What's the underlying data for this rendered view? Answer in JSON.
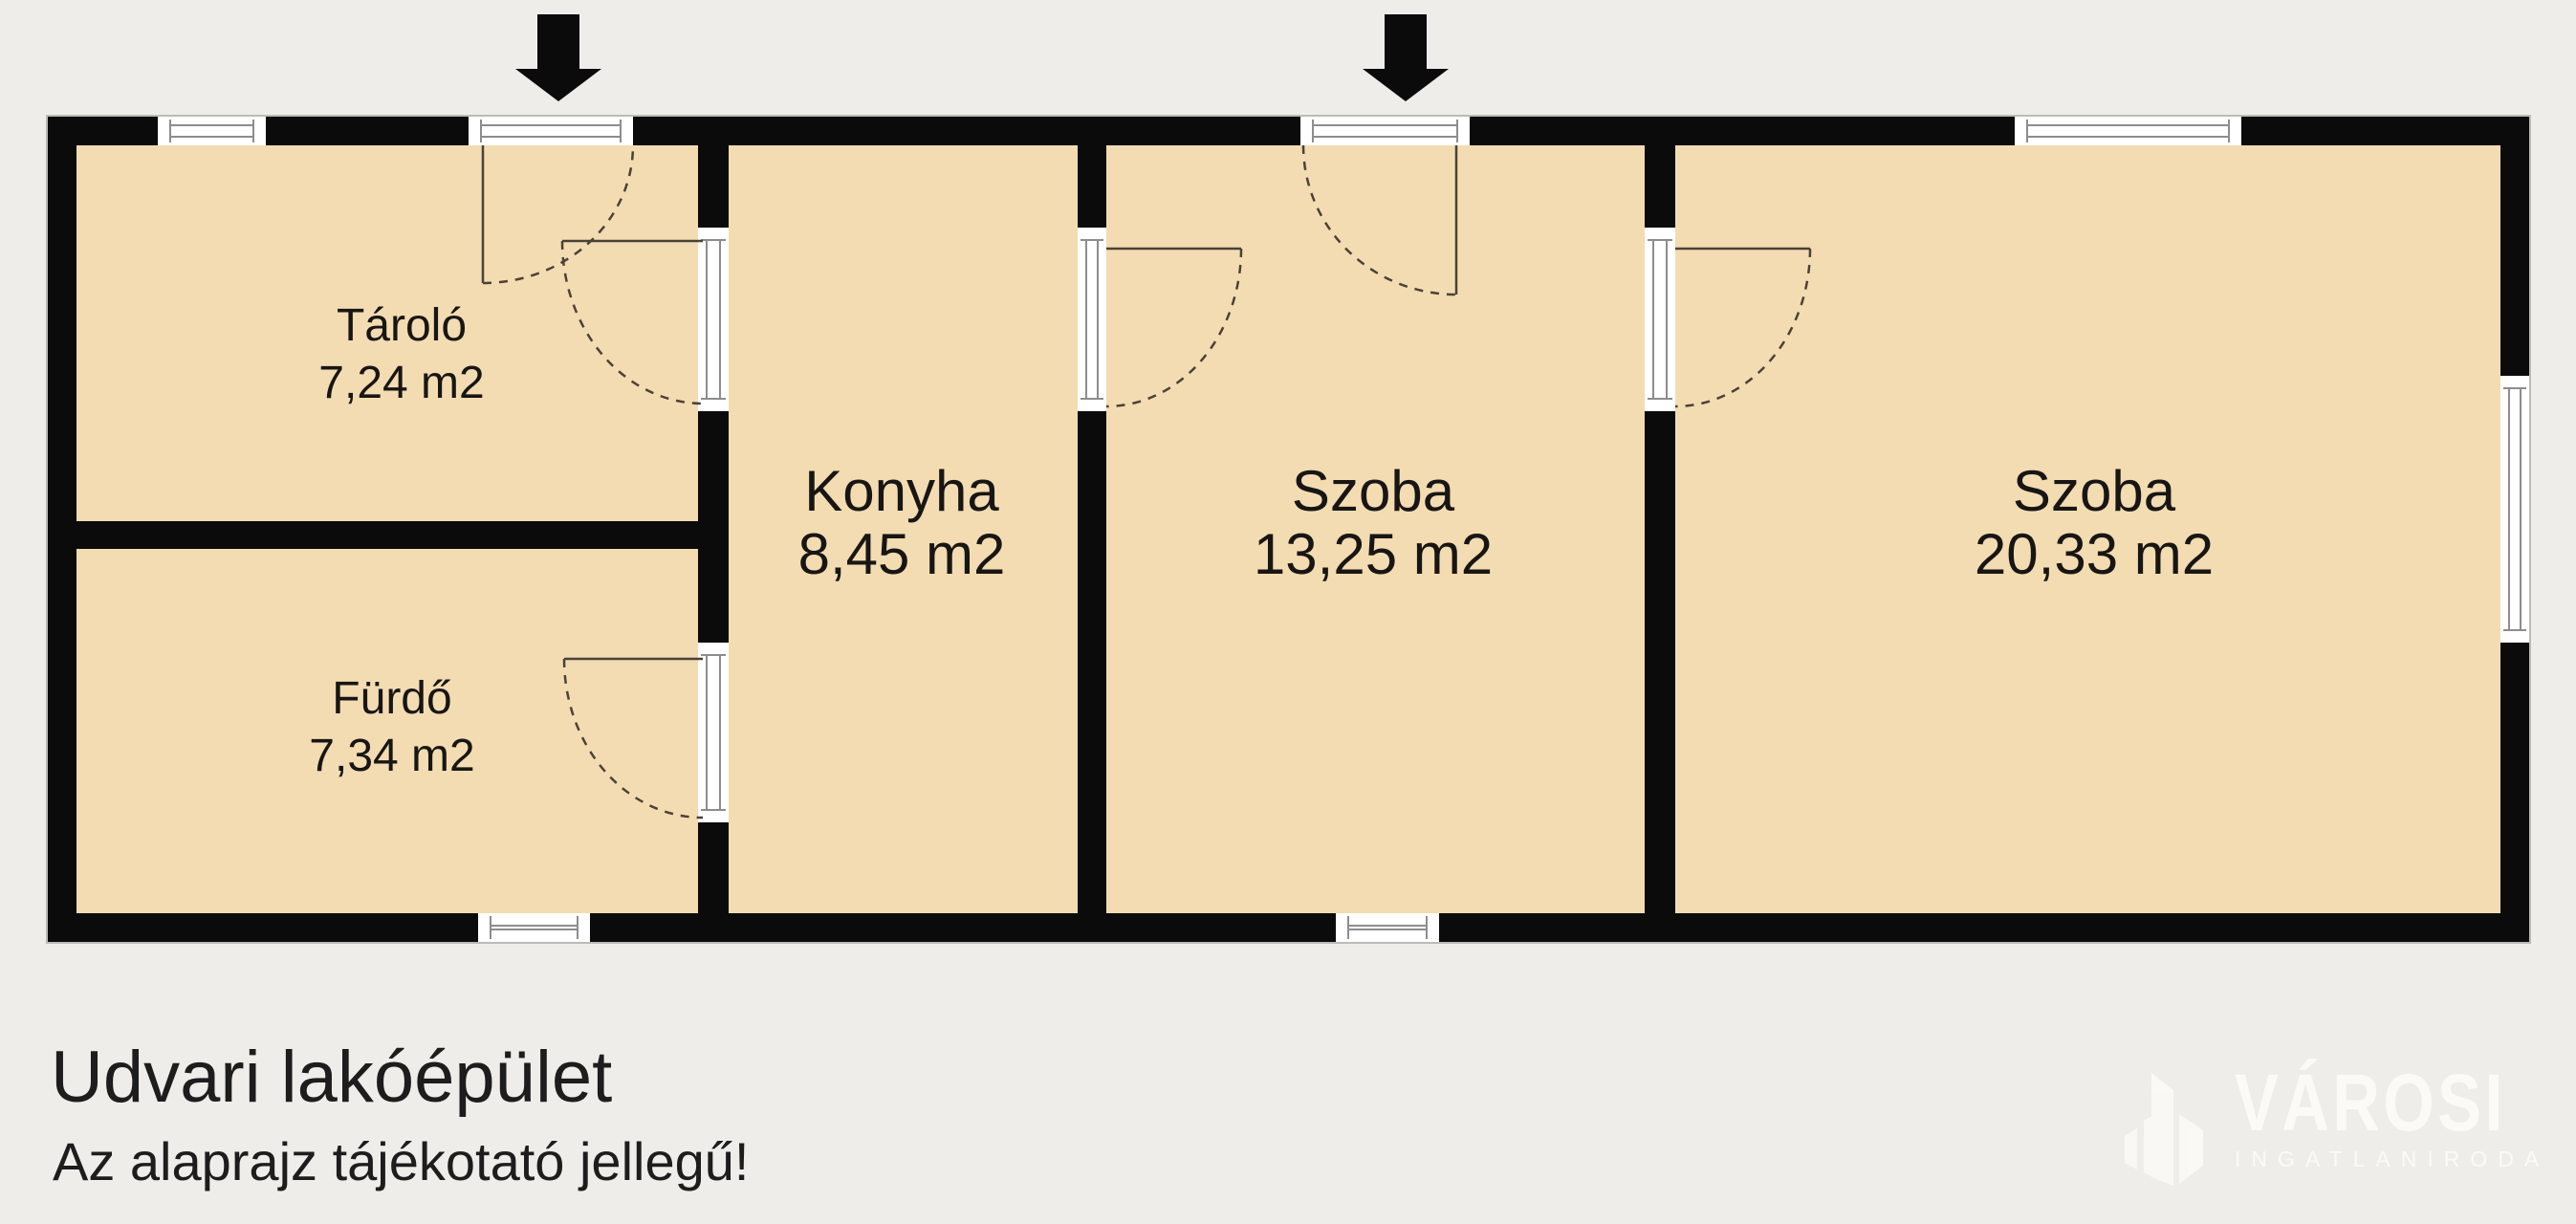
{
  "colors": {
    "background": "#efede9",
    "floor": "#f3dcb2",
    "wall": "#0b0b0b",
    "frame-line": "#8d8d8d",
    "swing": "#4a4238",
    "text": "#181614",
    "logo": "#fbfaf6"
  },
  "rooms": [
    {
      "name": "Tároló",
      "area": "7,24 m2"
    },
    {
      "name": "Fürdő",
      "area": "7,34 m2"
    },
    {
      "name": "Konyha",
      "area": "8,45 m2"
    },
    {
      "name": "Szoba",
      "area": "13,25 m2"
    },
    {
      "name": "Szoba",
      "area": "20,33 m2"
    }
  ],
  "icons": {
    "entrance_arrow": "down-arrow"
  },
  "footer": {
    "title": "Udvari lakóépület",
    "disclaimer": "Az alaprajz tájékotató jellegű!"
  },
  "logo": {
    "brand": "VÁROSI",
    "subtitle": "INGATLANIRODA"
  }
}
